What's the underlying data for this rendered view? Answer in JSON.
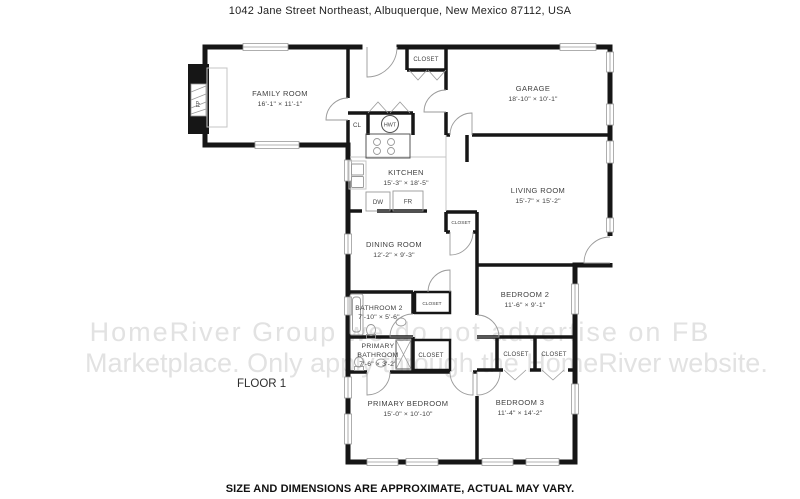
{
  "page": {
    "address": "1042 Jane Street Northeast, Albuquerque, New Mexico 87112, USA",
    "floor_label": "FLOOR 1",
    "disclaimer": "SIZE AND DIMENSIONS ARE APPROXIMATE, ACTUAL MAY VARY.",
    "watermark_line1": "HomeRiver Group we do not advertise on FB",
    "watermark_line2": "Marketplace. Only apply through the HomeRiver website."
  },
  "rooms": {
    "family": {
      "name": "FAMILY ROOM",
      "dims": "16'-1\" × 11'-1\""
    },
    "garage": {
      "name": "GARAGE",
      "dims": "18'-10\" × 10'-1\""
    },
    "kitchen": {
      "name": "KITCHEN",
      "dims": "15'-3\" × 18'-5\""
    },
    "living": {
      "name": "LIVING ROOM",
      "dims": "15'-7\" × 15'-2\""
    },
    "dining": {
      "name": "DINING ROOM",
      "dims": "12'-2\" × 9'-3\""
    },
    "bedroom2": {
      "name": "BEDROOM 2",
      "dims": "11'-6\" × 9'-1\""
    },
    "bathroom2": {
      "name": "BATHROOM 2",
      "dims": "7'-10\" × 5'-6\""
    },
    "primary_bathroom": {
      "line1": "PRIMARY",
      "line2": "BATHROOM",
      "dims": "7'-6\" × 3'-2\""
    },
    "primary_bedroom": {
      "name": "PRIMARY BEDROOM",
      "dims": "15'-0\" × 10'-10\""
    },
    "bedroom3": {
      "name": "BEDROOM 3",
      "dims": "11'-4\" × 14'-2\""
    }
  },
  "labels": {
    "closet": "CLOSET",
    "cl": "CL",
    "hwt": "HWT",
    "dw": "DW",
    "fr": "FR",
    "fp": "FP"
  },
  "colors": {
    "wall": "#161616",
    "label_text": "#3f3f3f",
    "thin_line": "#9a9a9a",
    "watermark": "#e2e2e2",
    "background": "#ffffff"
  }
}
